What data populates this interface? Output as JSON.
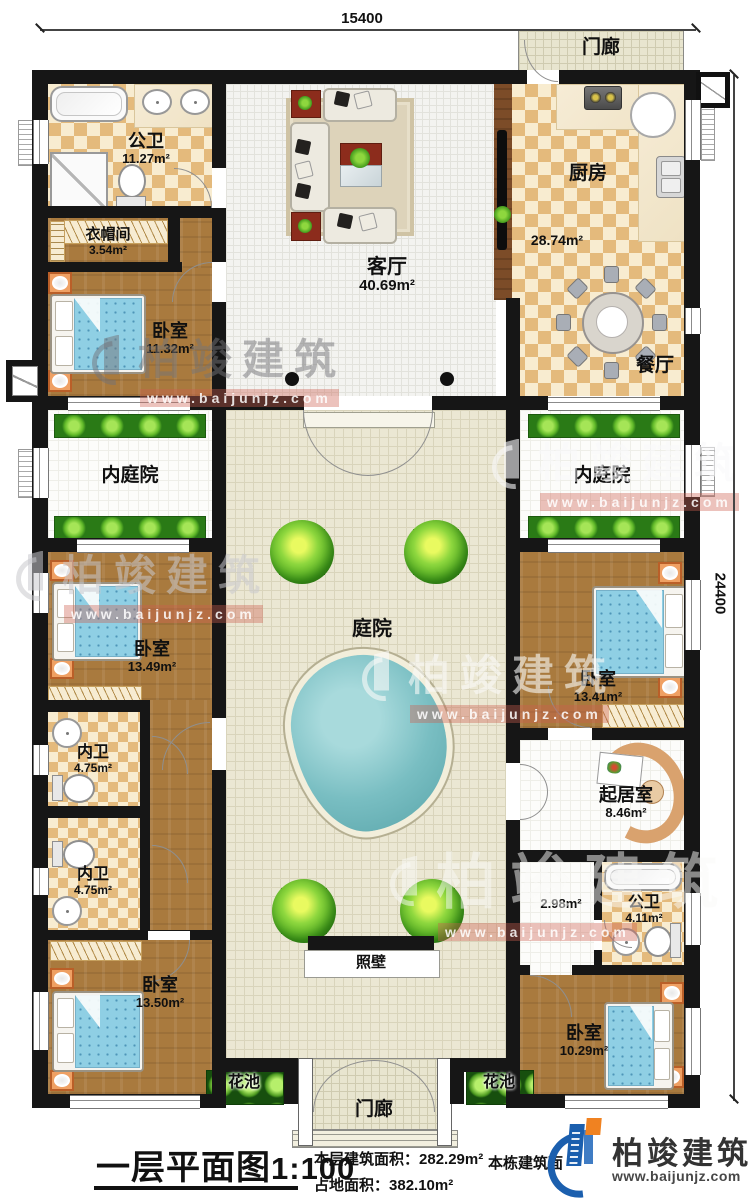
{
  "dimensions": {
    "top_width": "15400",
    "right_height": "24400"
  },
  "rooms": {
    "porch_top": {
      "label": "门廊"
    },
    "bath_top": {
      "label": "公卫",
      "area": "11.27m²"
    },
    "cloakroom": {
      "label": "衣帽间",
      "area": "3.54m²"
    },
    "bedroom_nw": {
      "label": "卧室",
      "area": "11.32m²"
    },
    "living": {
      "label": "客厅",
      "area": "40.69m²"
    },
    "kitchen": {
      "label": "厨房",
      "area": "28.74m²"
    },
    "dining": {
      "label": "餐厅"
    },
    "inner_court_left": {
      "label": "内庭院"
    },
    "inner_court_right": {
      "label": "内庭院"
    },
    "courtyard": {
      "label": "庭院"
    },
    "bedroom_w2": {
      "label": "卧室",
      "area": "13.49m²"
    },
    "bath_w1": {
      "label": "内卫",
      "area": "4.75m²"
    },
    "bath_w2": {
      "label": "内卫",
      "area": "4.75m²"
    },
    "bedroom_w3": {
      "label": "卧室",
      "area": "13.50m²"
    },
    "bedroom_e2": {
      "label": "卧室",
      "area": "13.41m²"
    },
    "sitting": {
      "label": "起居室",
      "area": "8.46m²"
    },
    "hall_e": {
      "area": "2.98m²"
    },
    "bath_e": {
      "label": "公卫",
      "area": "4.11m²"
    },
    "bedroom_e3": {
      "label": "卧室",
      "area": "10.29m²"
    },
    "screen_wall": {
      "label": "照壁"
    },
    "flower_left": {
      "label": "花池"
    },
    "flower_right": {
      "label": "花池"
    },
    "porch_bottom": {
      "label": "门廊"
    }
  },
  "title_block": {
    "title": "一层平面图",
    "scale": "1:100",
    "floor_area_label": "本层建筑面积：",
    "floor_area_value": "282.29m²",
    "land_area_label": "占地面积：",
    "land_area_value": "382.10m²",
    "building_area_label": "本栋建筑面"
  },
  "brand": {
    "name": "柏竣建筑",
    "url": "www.baijunjz.com"
  },
  "watermark": {
    "name": "柏竣建筑",
    "url": "www.baijunjz.com"
  },
  "colors": {
    "wall": "#161616",
    "checker": "#e4ba7c",
    "wood": "#a97a3e",
    "planter": "#2a7a16",
    "pool": "#79bec2",
    "logo_blue": "#1b5fae",
    "logo_orange": "#f08221"
  }
}
